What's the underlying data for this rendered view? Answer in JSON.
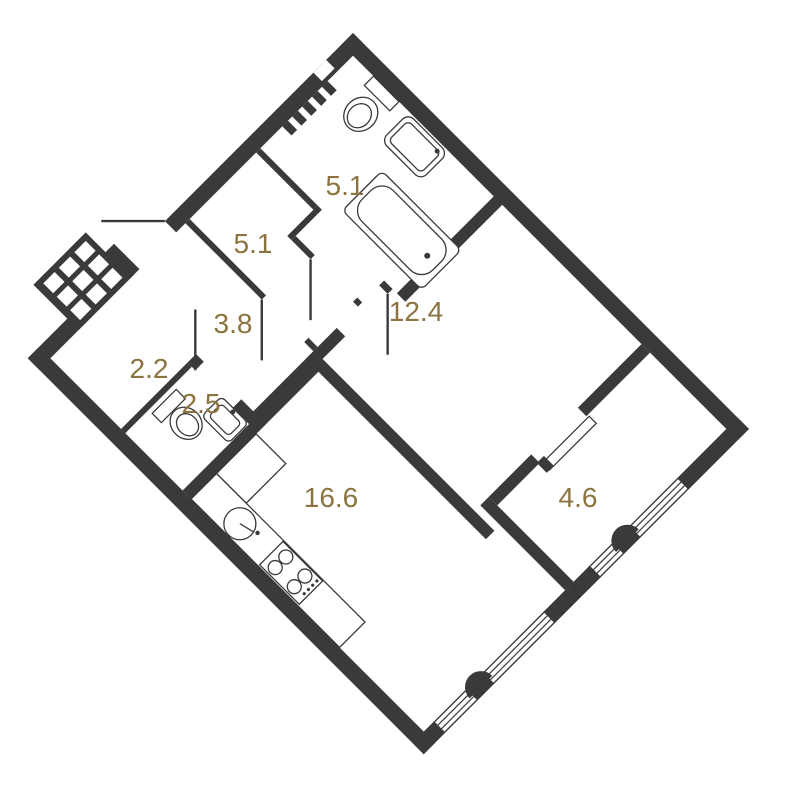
{
  "colors": {
    "wall": "#3b3a38",
    "label": "#8c7440",
    "background": "#ffffff"
  },
  "rooms": [
    {
      "id": "bathroom",
      "area": "5.1"
    },
    {
      "id": "hallway",
      "area": "5.1"
    },
    {
      "id": "living-room",
      "area": "12.4"
    },
    {
      "id": "corridor",
      "area": "3.8"
    },
    {
      "id": "entry-hall",
      "area": "2.2"
    },
    {
      "id": "wc",
      "area": "2.5"
    },
    {
      "id": "kitchen-living",
      "area": "16.6"
    },
    {
      "id": "balcony",
      "area": "4.6"
    }
  ]
}
